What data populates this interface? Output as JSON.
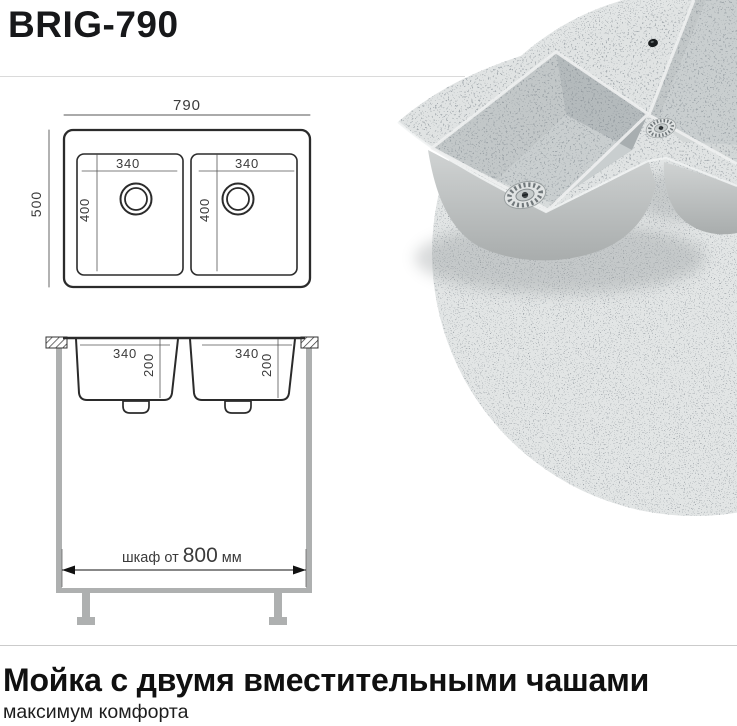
{
  "title": "BRIG-790",
  "plan_view": {
    "overall_width": "790",
    "overall_depth": "500",
    "bowl_width": "340",
    "bowl_depth": "400"
  },
  "section_view": {
    "bowl_width": "340",
    "bowl_height": "200",
    "cabinet_label_prefix": "шкаф от ",
    "cabinet_value": "800",
    "cabinet_unit": " мм"
  },
  "footer": {
    "heading": "Мойка с двумя вместительными чашами",
    "subheading": "максимум комфорта"
  },
  "colors": {
    "granite_light": "#e2e5e5",
    "drawing_line": "#2b2b2b",
    "cabinet_gray": "#aeb0b0",
    "accent_text": "#17181a"
  }
}
